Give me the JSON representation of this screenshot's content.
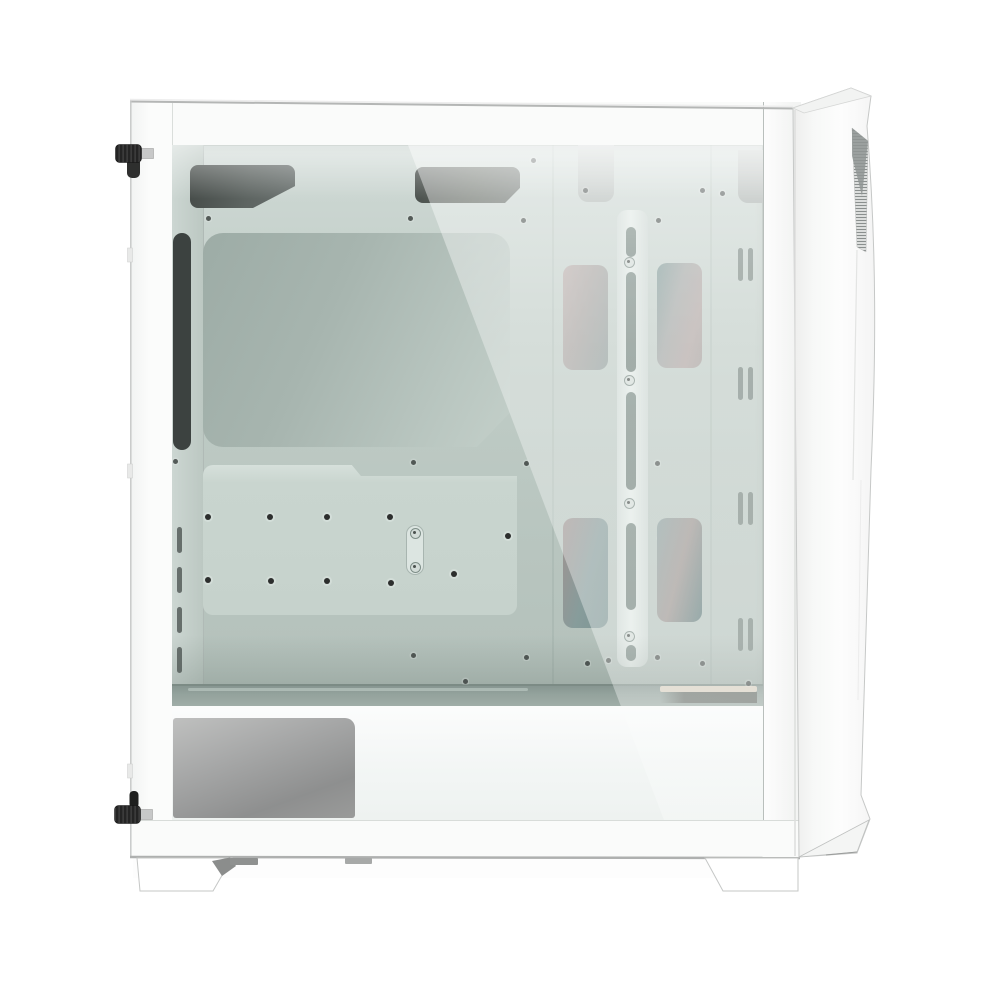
{
  "meta": {
    "description": "Product photo: white mid-tower PC gaming case, side view with tinted tempered-glass side panel, angular white front panel with mesh vent strip, PSU shroud and two trapezoid feet. No text visible in image.",
    "background": "#ffffff",
    "text_content": []
  },
  "palette": {
    "bg": "#ffffff",
    "frame": "#fafbfa",
    "glassTop": "#cfd9d5",
    "glassBottom": "#aebbb5",
    "cutoutDark": "#6b7270",
    "stripDark": "#3c4240",
    "recessFrom": "#9daca6",
    "recessTo": "#c3cfc9",
    "plate": "#c9d5cf",
    "rail": "#e2eae6",
    "slotDark": "#7e8e88",
    "ventDark": "#6d7b76",
    "shelf": "#93a29c",
    "shelfEdge": "#7c8b85",
    "shroud": "#f3f6f5",
    "silverDark": "#8e8f8f",
    "tan": "#d8cfc0",
    "dot": "#3f4543",
    "panel": "#fbfcfb",
    "mesh": "#8f9594",
    "screwBlack": "#242424"
  },
  "interior": {
    "glass_origin": [
      172,
      145
    ],
    "screw_dots": [
      [
        533,
        160
      ],
      [
        585,
        190
      ],
      [
        702,
        190
      ],
      [
        722,
        193
      ],
      [
        208,
        218
      ],
      [
        410,
        218
      ],
      [
        523,
        220
      ],
      [
        658,
        220
      ],
      [
        175,
        461
      ],
      [
        413,
        462
      ],
      [
        526,
        463
      ],
      [
        657,
        463
      ],
      [
        660,
        538
      ],
      [
        465,
        681
      ],
      [
        413,
        655
      ],
      [
        526,
        657
      ],
      [
        587,
        663
      ],
      [
        608,
        660
      ],
      [
        657,
        657
      ],
      [
        702,
        663
      ],
      [
        748,
        683
      ]
    ],
    "standoffs": [
      [
        208,
        517
      ],
      [
        270,
        517
      ],
      [
        327,
        517
      ],
      [
        390,
        517
      ],
      [
        208,
        580
      ],
      [
        271,
        581
      ],
      [
        327,
        581
      ],
      [
        391,
        583
      ],
      [
        454,
        574
      ],
      [
        508,
        536
      ]
    ],
    "capsule_screws": [
      [
        415,
        533
      ],
      [
        415,
        567
      ]
    ],
    "rail_screws": [
      [
        629,
        262
      ],
      [
        629,
        380
      ],
      [
        629,
        503
      ],
      [
        629,
        636
      ]
    ],
    "rail_slots_abs": [
      [
        227,
        30
      ],
      [
        272,
        100
      ],
      [
        392,
        98
      ],
      [
        523,
        87
      ],
      [
        645,
        16
      ]
    ],
    "vent_groups_y": [
      248,
      367,
      492,
      618
    ],
    "vent_xs": [
      738,
      748
    ],
    "rear_dashes_y": [
      527,
      567,
      607,
      647
    ],
    "fan_cutouts": [
      {
        "x": 563,
        "y": 265,
        "w": 45,
        "h": 105,
        "grad": "linear-gradient(105deg,#b9aeab 0%,#a8a5a2 45%,#93a09e 100%)"
      },
      {
        "x": 657,
        "y": 263,
        "w": 45,
        "h": 105,
        "grad": "linear-gradient(105deg,#7f9997 0%,#a3a7a5 40%,#b0a6a3 75%,#a5a09d 100%)"
      },
      {
        "x": 563,
        "y": 518,
        "w": 45,
        "h": 110,
        "grad": "linear-gradient(105deg,#9f9391 0%,#879c9b 55%,#7e9594 100%)"
      },
      {
        "x": 657,
        "y": 518,
        "w": 45,
        "h": 104,
        "grad": "linear-gradient(105deg,#8a9e9d 0%,#9b9490 50%,#5f7c7c 100%)"
      }
    ]
  }
}
